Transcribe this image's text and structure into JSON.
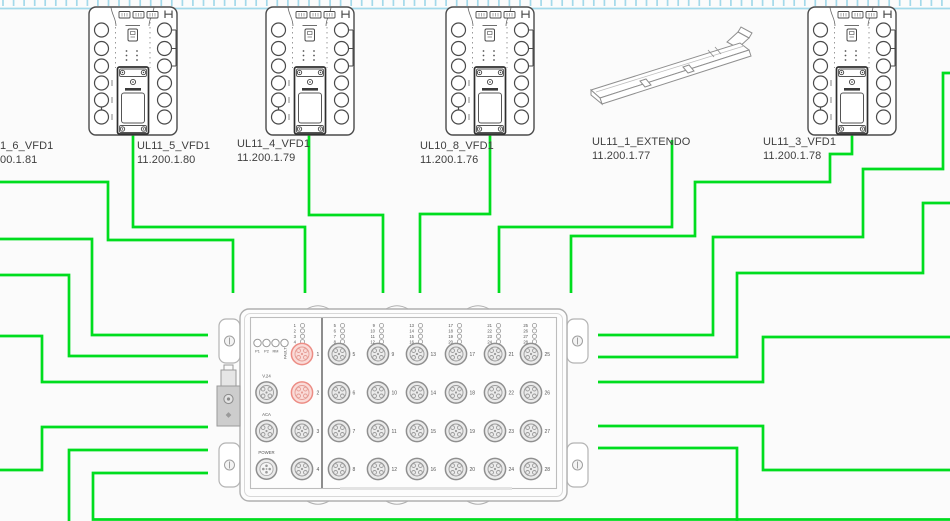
{
  "canvas": {
    "width": 950,
    "height": 521,
    "background": "#fbfbfb"
  },
  "ruler": {
    "color": "#a3d9ea",
    "spacing": 10.55,
    "tick_height": 6
  },
  "colors": {
    "cable": "#00dd1e",
    "device_stroke": "#4a4a4a",
    "switch_stroke": "#b2b2b2",
    "port_fill": "#ebebeb",
    "port_stroke": "#8f8f8f",
    "port_red_fill": "#fadbd8",
    "port_red_stroke": "#ec8c84"
  },
  "devices": [
    {
      "name": "1_6_VFD1",
      "ip": "00.1.81"
    },
    {
      "name": "UL11_5_VFD1",
      "ip": "11.200.1.80"
    },
    {
      "name": "UL11_4_VFD1",
      "ip": "11.200.1.79"
    },
    {
      "name": "UL10_8_VFD1",
      "ip": "11.200.1.76"
    },
    {
      "name": "UL11_1_EXTENDO",
      "ip": "11.200.1.77"
    },
    {
      "name": "UL11_3_VFD1",
      "ip": "11.200.1.78"
    }
  ],
  "switch": {
    "status_leds": [
      "P1",
      "P2",
      "RM",
      "FAULT"
    ],
    "service_ports": [
      "V.24",
      "ACA",
      "POWER"
    ],
    "left_ports": [
      1,
      2,
      3,
      4
    ],
    "port_columns": [
      [
        5,
        6,
        7,
        8
      ],
      [
        9,
        10,
        11,
        12
      ],
      [
        13,
        14,
        15,
        16
      ],
      [
        17,
        18,
        19,
        20
      ],
      [
        21,
        22,
        23,
        24
      ],
      [
        25,
        26,
        27,
        28
      ]
    ],
    "highlighted_ports": [
      1,
      2
    ]
  },
  "cables": [
    {
      "name": "cable-ul11-6-vfd1",
      "points": "0,182 108,182 108,240 233,240 233,293"
    },
    {
      "name": "cable-ul11-5-vfd1",
      "points": "133,135 133,227 305,227 305,293"
    },
    {
      "name": "cable-ul11-4-vfd1",
      "points": "309,135 309,215 383,215 383,293"
    },
    {
      "name": "cable-ul10-8-vfd1",
      "points": "490,135 490,214 420,214 420,293"
    },
    {
      "name": "cable-ul11-1-extendo",
      "points": "672,140 672,227 499,227 499,293"
    },
    {
      "name": "cable-ul11-3-vfd1",
      "points": "852,135 852,154 830,154 830,182 695,182 695,236 571,236 571,293"
    },
    {
      "name": "cable-right-1",
      "points": "950,73 943,73 943,169 863,169 863,237 713,237 713,335 598,335"
    },
    {
      "name": "cable-right-2",
      "points": "950,203 923,203 923,273 737,273 737,357 598,357"
    },
    {
      "name": "cable-right-3",
      "points": "950,337 763,337 763,382 598,382"
    },
    {
      "name": "cable-right-4",
      "points": "598,426 763,426 763,470 950,470"
    },
    {
      "name": "cable-right-5",
      "points": "598,448 737,448 737,521"
    },
    {
      "name": "cable-left-1",
      "points": "0,239 92,239 92,335 208,335"
    },
    {
      "name": "cable-left-2",
      "points": "0,275 69,275 69,356 208,356"
    },
    {
      "name": "cable-left-3",
      "points": "0,336 42,336 42,382 208,382"
    },
    {
      "name": "cable-left-4",
      "points": "0,470 42,470 42,427 208,427"
    },
    {
      "name": "cable-left-5",
      "points": "208,450 69,450 69,521"
    },
    {
      "name": "cable-left-6",
      "points": "208,473 93,473 93,519.5 950,519.5"
    }
  ]
}
